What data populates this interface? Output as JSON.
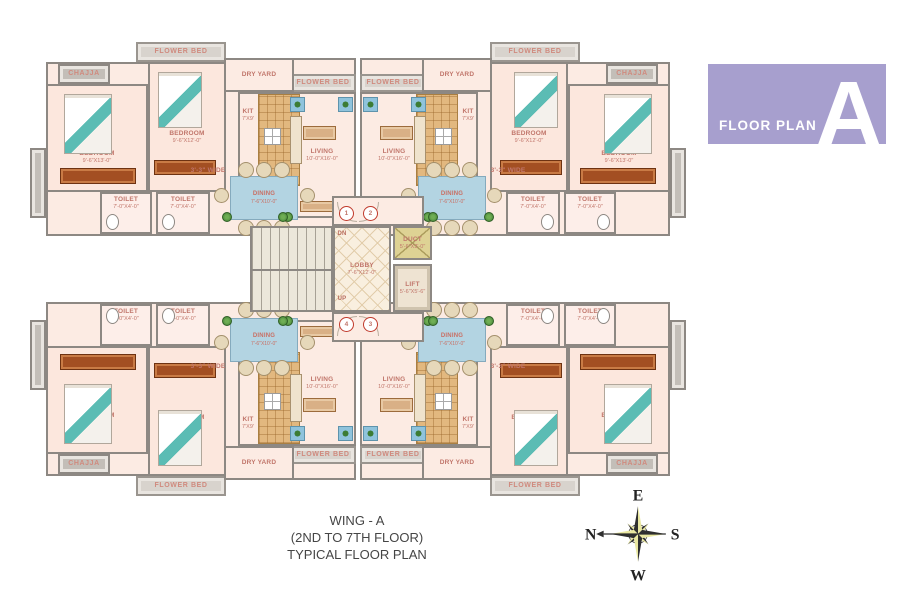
{
  "badge": {
    "label": "FLOOR PLAN",
    "letter": "A"
  },
  "caption": {
    "line1": "WING - A",
    "line2": "(2ND TO 7TH FLOOR)",
    "line3": "TYPICAL FLOOR PLAN"
  },
  "compass": {
    "top": "E",
    "right": "S",
    "bottom": "W",
    "left": "N"
  },
  "units": {
    "u1": "1",
    "u2": "2",
    "u3": "3",
    "u4": "4"
  },
  "stairs": {
    "dn": "DN",
    "up": "UP"
  },
  "rooms": {
    "flower_bed": "FLOWER BED",
    "dry_yard": "DRY YARD",
    "chajja": "CHAJJA",
    "passage": "3'-3\" WIDE",
    "bedroom_large": {
      "name": "BEDROOM",
      "dim": "9'-6\"X13'-0\""
    },
    "bedroom_small": {
      "name": "BEDROOM",
      "dim": "9'-6\"X12'-0\""
    },
    "toilet": {
      "name": "TOILET",
      "dim": "7'-0\"X4'-0\""
    },
    "kitchen": {
      "name": "KIT",
      "dim": "7'X9'"
    },
    "living": {
      "name": "LIVING",
      "dim": "10'-0\"X16'-0\""
    },
    "dining": {
      "name": "DINING",
      "dim": "7'-6\"X10'-0\""
    },
    "lobby": {
      "name": "LOBBY",
      "dim": "7'-6\"X12'-0\""
    },
    "lift": {
      "name": "LIFT",
      "dim": "5'-6\"X5'-6\""
    },
    "duct": {
      "name": "DUCT",
      "dim": "5'-6\"X3'-0\""
    }
  },
  "colors": {
    "accent": "#a79fce",
    "wall": "#8d8883",
    "room_label": "#c1766b"
  }
}
